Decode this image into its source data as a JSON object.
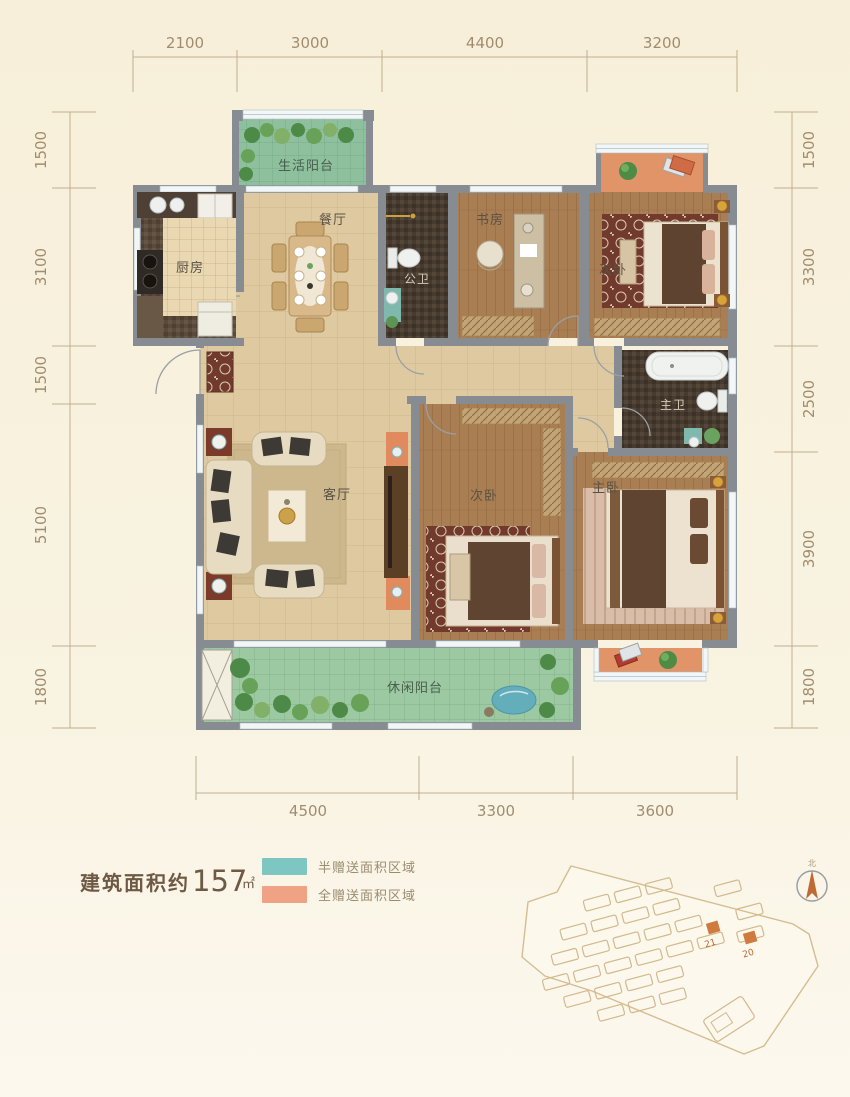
{
  "dimensions": {
    "top": [
      "2100",
      "3000",
      "4400",
      "3200"
    ],
    "bottom": [
      "4500",
      "3300",
      "3600"
    ],
    "left": [
      "1500",
      "3100",
      "1500",
      "5100",
      "1800"
    ],
    "right": [
      "1500",
      "3300",
      "2500",
      "3900",
      "1800"
    ]
  },
  "rooms": {
    "life_balcony": "生活阳台",
    "dining": "餐厅",
    "kitchen": "厨房",
    "public_bath": "公卫",
    "study": "书房",
    "bedroom_top": "次卧",
    "living": "客厅",
    "bedroom_mid": "次卧",
    "master_bedroom": "主卧",
    "master_bath": "主卫",
    "leisure_balcony": "休闲阳台"
  },
  "info": {
    "area_prefix": "建筑面积约",
    "area_value": "157",
    "area_unit": "㎡"
  },
  "legend": [
    {
      "label": "半赠送面积区域",
      "color": "#7dc6c2"
    },
    {
      "label": "全赠送面积区域",
      "color": "#f0a284"
    }
  ],
  "site_plan": {
    "highlighted_units": [
      "21",
      "20"
    ],
    "compass_label": "北"
  },
  "colors": {
    "background": "#f8f1de",
    "wall": "#868c92",
    "dim_text": "#a28c6e",
    "tile_floor": "#dfc9a0",
    "wood_floor": "#a97e53",
    "bath_floor": "#473a2e",
    "balcony_floor": "#8fc09e",
    "gift_full": "#e09467",
    "highlight_building": "#cf7a3e"
  }
}
